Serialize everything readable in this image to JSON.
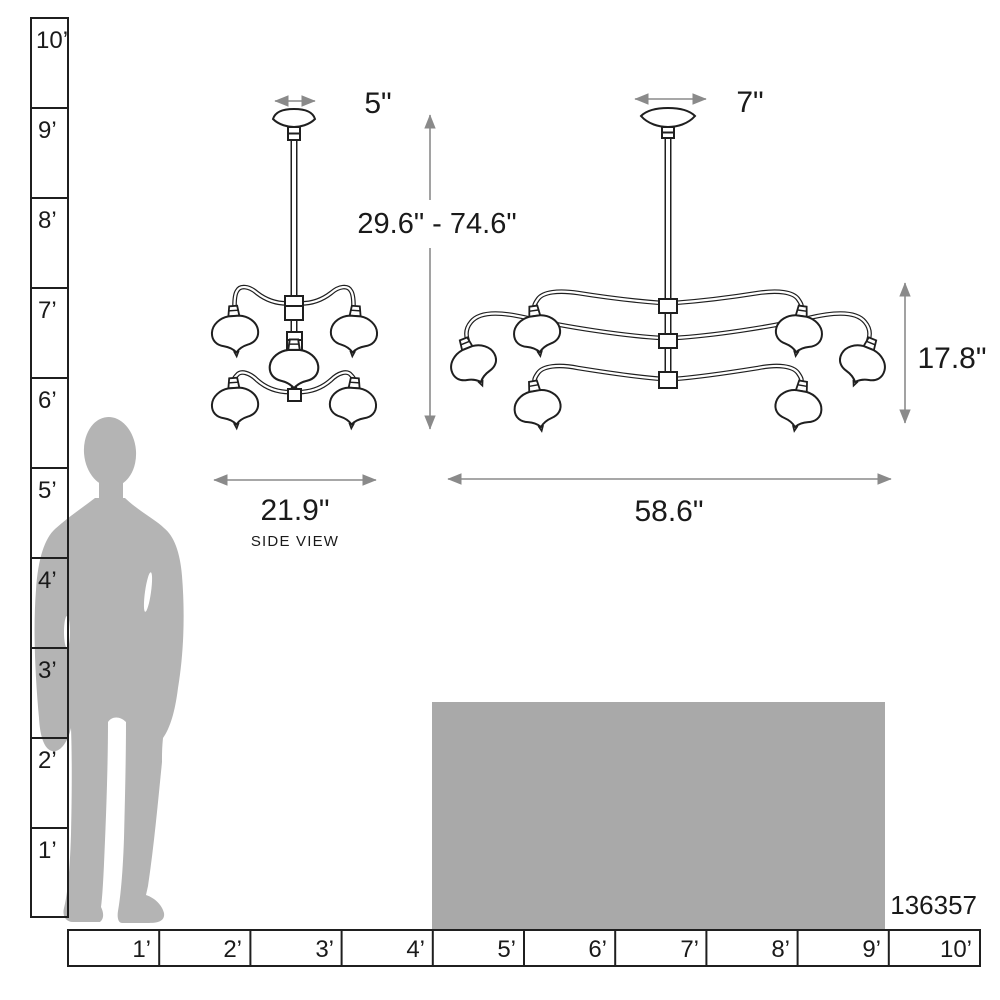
{
  "colors": {
    "background": "#ffffff",
    "line": "#1f1f1f",
    "dimension": "#8a8a8a",
    "silhouette": "#b4b4b4",
    "furniture": "#a9a9a9",
    "text": "#1a1a1a"
  },
  "vertical_ruler": {
    "labels": [
      "10’",
      "9’",
      "8’",
      "7’",
      "6’",
      "5’",
      "4’",
      "3’",
      "2’",
      "1’"
    ]
  },
  "horizontal_ruler": {
    "labels": [
      "1’",
      "2’",
      "3’",
      "4’",
      "5’",
      "6’",
      "7’",
      "8’",
      "9’",
      "10’"
    ]
  },
  "side_view": {
    "canopy_width": "5\"",
    "fixture_width": "21.9\"",
    "caption": "SIDE VIEW"
  },
  "front_view": {
    "canopy_width": "7\"",
    "fixture_width": "58.6\"",
    "fixture_height": "17.8\""
  },
  "overall_height_range": "29.6\" - 74.6\"",
  "product_id": "136357"
}
